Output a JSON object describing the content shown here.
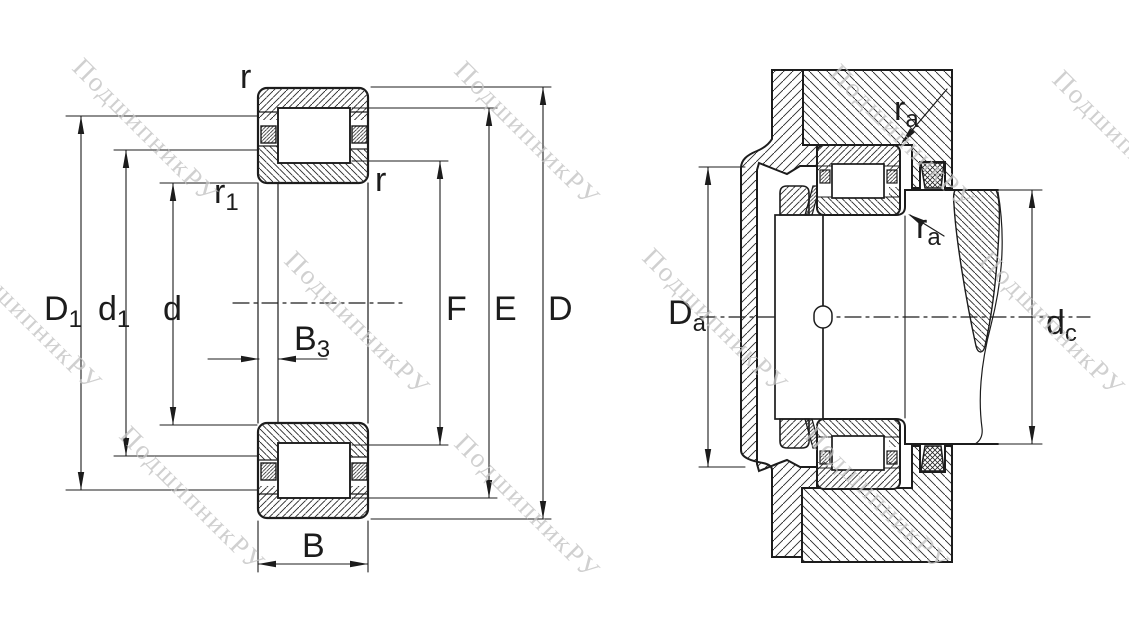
{
  "watermark": {
    "text": "ПодшипникРУ",
    "color": "#c3c3c3"
  },
  "left_view": {
    "title": "bearing-cross-section",
    "labels": {
      "r_top": "r",
      "r_right": "r",
      "r1_base": "r",
      "r1_sub": "1",
      "D1_base": "D",
      "D1_sub": "1",
      "d1_base": "d",
      "d1_sub": "1",
      "d": "d",
      "B3_base": "B",
      "B3_sub": "3",
      "B": "B",
      "F": "F",
      "E": "E",
      "D": "D"
    }
  },
  "right_view": {
    "title": "bearing-mounting-section",
    "labels": {
      "Da_base": "D",
      "Da_sub": "a",
      "dc_base": "d",
      "dc_sub": "c",
      "ra_top_base": "r",
      "ra_top_sub": "a",
      "ra_bottom_base": "r",
      "ra_bottom_sub": "a"
    }
  },
  "colors": {
    "line": "#1c1c1c",
    "background": "#ffffff"
  }
}
